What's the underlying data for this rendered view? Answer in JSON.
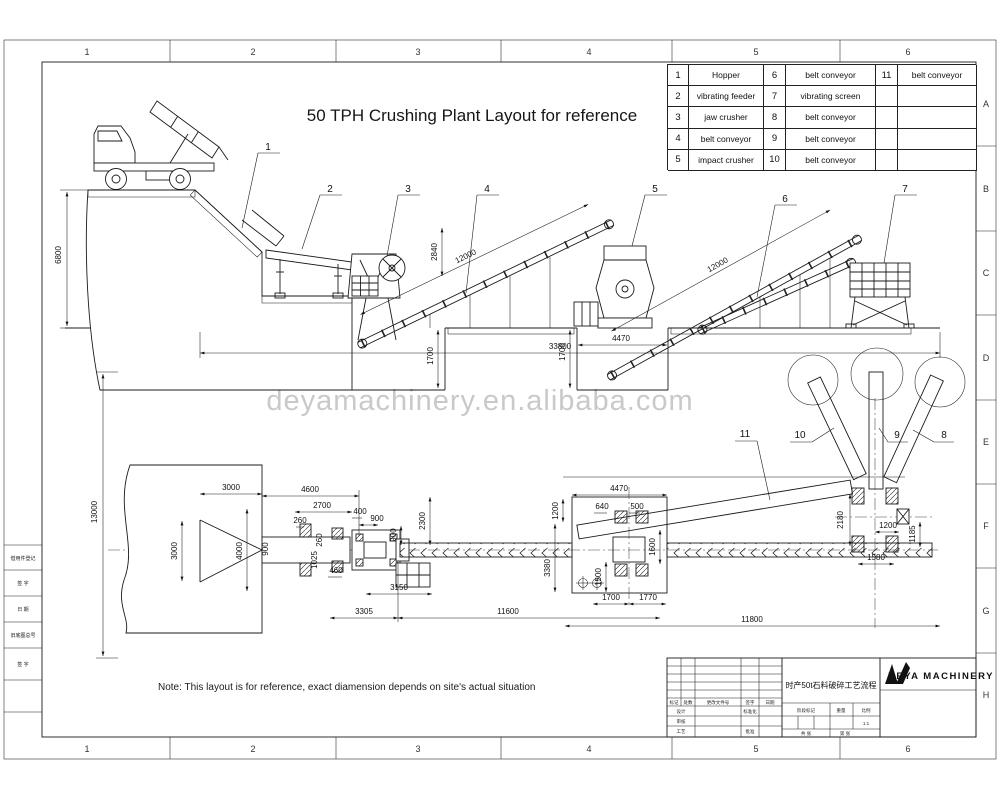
{
  "sheet": {
    "grid_cols": [
      "1",
      "2",
      "3",
      "4",
      "5",
      "6"
    ],
    "grid_rows": [
      "A",
      "B",
      "C",
      "D",
      "E",
      "F",
      "G",
      "H"
    ]
  },
  "title": "50 TPH Crushing Plant Layout for reference",
  "watermark": "deyamachinery.en.alibaba.com",
  "note": "Note: This layout is for reference, exact diamension depends on site's actual situation",
  "parts_table": {
    "rows": [
      {
        "n1": "1",
        "p1": "Hopper",
        "n2": "6",
        "p2": "belt conveyor",
        "n3": "11",
        "p3": "belt conveyor"
      },
      {
        "n1": "2",
        "p1": "vibrating feeder",
        "n2": "7",
        "p2": "vibrating screen",
        "n3": "",
        "p3": ""
      },
      {
        "n1": "3",
        "p1": "jaw crusher",
        "n2": "8",
        "p2": "belt conveyor",
        "n3": "",
        "p3": ""
      },
      {
        "n1": "4",
        "p1": "belt conveyor",
        "n2": "9",
        "p2": "belt conveyor",
        "n3": "",
        "p3": ""
      },
      {
        "n1": "5",
        "p1": "impact crusher",
        "n2": "10",
        "p2": "belt conveyor",
        "n3": "",
        "p3": ""
      }
    ]
  },
  "callouts": {
    "c1": "1",
    "c2": "2",
    "c3": "3",
    "c4": "4",
    "c5": "5",
    "c6": "6",
    "c7": "7",
    "c8": "8",
    "c9": "9",
    "c10": "10",
    "c11": "11"
  },
  "elev_dims": {
    "height": "6800",
    "hopper_h": "2840",
    "conv4_len": "12000",
    "pit1_depth": "1700",
    "conv6_len": "12000",
    "pit2_depth": "1700",
    "pit2_w": "4470",
    "overall": "33800"
  },
  "plan_dims": {
    "v13000": "13000",
    "h3000": "3000",
    "v3000": "3000",
    "v4000": "4000",
    "h4600": "4600",
    "h2700": "2700",
    "h260": "260",
    "v260": "260",
    "v900": "900",
    "v1025": "1025",
    "h460": "460",
    "h400": "400",
    "h900": "900",
    "v900b": "900",
    "v2300": "2300",
    "h3150": "3150",
    "h3305": "3305",
    "h11600": "11600",
    "v1200": "1200",
    "h640": "640",
    "h500": "500",
    "v3380": "3380",
    "v1500": "1500",
    "v1600": "1600",
    "h1700": "1700",
    "h1770": "1770",
    "h11800": "11800",
    "h4470": "4470",
    "v2180": "2180",
    "h1200b": "1200",
    "v1185": "1185",
    "h1580": "1580"
  },
  "title_block": {
    "title_cn": "时产50t石料破碎工艺流程",
    "company": "DEYA MACHINERY",
    "scale_value": "1:1",
    "fields": {
      "mark": "标记",
      "count": "处数",
      "change_doc": "更改文件号",
      "sign": "签字",
      "date": "日期",
      "design": "设计",
      "standardize": "标准化",
      "check": "审核",
      "process": "工艺",
      "approve": "批准",
      "stage_mark": "阶段标记",
      "weight": "重量",
      "scale": "比例",
      "sheets": "共 张",
      "sheet_no": "第 张"
    }
  },
  "left_margin": {
    "rows": [
      "借用件登记",
      "签 字",
      "日 期",
      "旧底图总号",
      "签 字"
    ]
  }
}
